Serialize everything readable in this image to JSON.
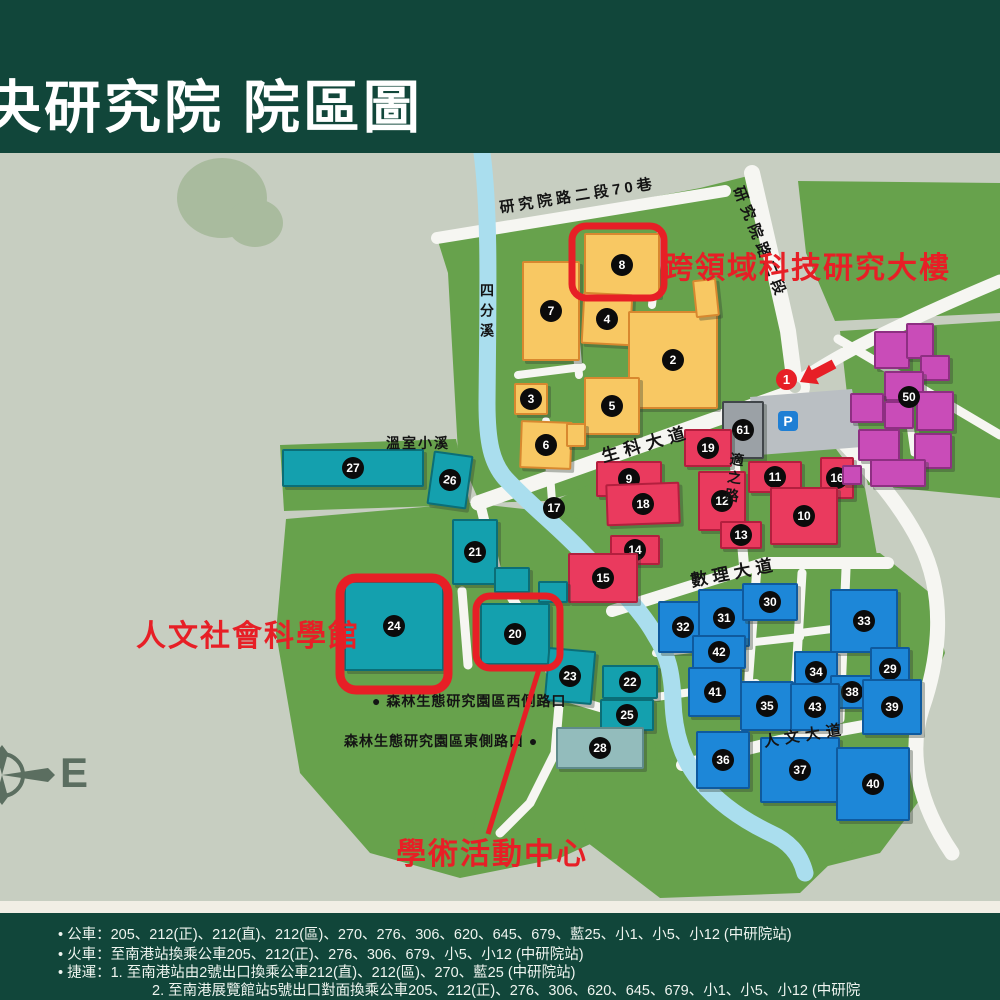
{
  "header": {
    "title": "中央研究院 院區圖"
  },
  "map": {
    "annotations": {
      "cross_domain": "跨領域科技研究大樓",
      "humanities": "人文社會科學館",
      "activity_center": "學術活動中心"
    },
    "markers": {
      "parking": "P",
      "gate": "1",
      "compass_east": "E"
    },
    "road_labels": [
      {
        "t": "研究院路二段70巷",
        "x": 498,
        "y": 44,
        "size": 15,
        "rot": -9,
        "spacing": 4
      },
      {
        "t": "研究院路二段",
        "x": 748,
        "y": 30,
        "size": 15,
        "rot": 68,
        "spacing": 5
      },
      {
        "t": "四分溪",
        "x": 477,
        "y": 130,
        "size": 14,
        "vertical": true,
        "spacing": 6
      },
      {
        "t": "溫室小溪",
        "x": 386,
        "y": 280,
        "size": 14,
        "spacing": 2
      },
      {
        "t": "生科大道",
        "x": 598,
        "y": 290,
        "size": 17,
        "rot": -16,
        "spacing": 6
      },
      {
        "t": "適之路",
        "x": 728,
        "y": 298,
        "size": 14,
        "vertical": true,
        "rot": 8,
        "spacing": 4
      },
      {
        "t": "數理大道",
        "x": 688,
        "y": 414,
        "size": 17,
        "rot": -11,
        "spacing": 5
      },
      {
        "t": "人文大道",
        "x": 762,
        "y": 578,
        "size": 15,
        "rot": -9,
        "spacing": 6
      },
      {
        "t": "● 森林生態研究園區西側路口",
        "x": 372,
        "y": 538,
        "size": 14,
        "spacing": 1
      },
      {
        "t": "森林生態研究園區東側路口 ●",
        "x": 344,
        "y": 578,
        "size": 14,
        "spacing": 1
      }
    ],
    "badges": [
      {
        "n": "17",
        "x": 554,
        "y": 355
      },
      {
        "n": "50",
        "x": 909,
        "y": 244
      }
    ],
    "buildings": [
      {
        "n": "7",
        "c": "yellow",
        "x": 522,
        "y": 108,
        "w": 54,
        "h": 96
      },
      {
        "n": "8",
        "c": "yellow",
        "x": 584,
        "y": 80,
        "w": 72,
        "h": 60
      },
      {
        "n": "4",
        "c": "yellow",
        "x": 582,
        "y": 140,
        "w": 46,
        "h": 48,
        "r": 3
      },
      {
        "n": "2",
        "c": "yellow",
        "x": 628,
        "y": 158,
        "w": 86,
        "h": 94
      },
      {
        "n": "3",
        "c": "yellow",
        "x": 514,
        "y": 230,
        "w": 30,
        "h": 28
      },
      {
        "n": "5",
        "c": "yellow",
        "x": 584,
        "y": 224,
        "w": 52,
        "h": 54
      },
      {
        "n": "6",
        "c": "yellow",
        "x": 520,
        "y": 268,
        "w": 48,
        "h": 44,
        "r": 2
      },
      {
        "n": "",
        "c": "yellow",
        "x": 566,
        "y": 270,
        "w": 16,
        "h": 20
      },
      {
        "n": "",
        "c": "yellow",
        "x": 694,
        "y": 126,
        "w": 20,
        "h": 34,
        "r": -6
      },
      {
        "n": "61",
        "c": "gray",
        "x": 722,
        "y": 248,
        "w": 38,
        "h": 54
      },
      {
        "n": "19",
        "c": "red",
        "x": 684,
        "y": 276,
        "w": 44,
        "h": 34
      },
      {
        "n": "9",
        "c": "red",
        "x": 596,
        "y": 308,
        "w": 62,
        "h": 32
      },
      {
        "n": "18",
        "c": "red",
        "x": 606,
        "y": 330,
        "w": 70,
        "h": 38,
        "r": -2
      },
      {
        "n": "12",
        "c": "red",
        "x": 698,
        "y": 318,
        "w": 44,
        "h": 56
      },
      {
        "n": "11",
        "c": "red",
        "x": 748,
        "y": 308,
        "w": 50,
        "h": 28
      },
      {
        "n": "16",
        "c": "red",
        "x": 820,
        "y": 304,
        "w": 30,
        "h": 38
      },
      {
        "n": "10",
        "c": "red",
        "x": 770,
        "y": 334,
        "w": 64,
        "h": 54
      },
      {
        "n": "13",
        "c": "red",
        "x": 720,
        "y": 368,
        "w": 38,
        "h": 24
      },
      {
        "n": "14",
        "c": "red",
        "x": 610,
        "y": 382,
        "w": 46,
        "h": 26
      },
      {
        "n": "15",
        "c": "red",
        "x": 568,
        "y": 400,
        "w": 66,
        "h": 46
      },
      {
        "n": "27",
        "c": "teal",
        "x": 282,
        "y": 296,
        "w": 138,
        "h": 34
      },
      {
        "n": "26",
        "c": "teal",
        "x": 430,
        "y": 300,
        "w": 36,
        "h": 50,
        "r": 8
      },
      {
        "n": "21",
        "c": "teal",
        "x": 452,
        "y": 366,
        "w": 42,
        "h": 62
      },
      {
        "n": "",
        "c": "teal",
        "x": 494,
        "y": 414,
        "w": 32,
        "h": 22
      },
      {
        "n": "",
        "c": "teal",
        "x": 538,
        "y": 428,
        "w": 26,
        "h": 18
      },
      {
        "n": "24",
        "c": "teal",
        "x": 344,
        "y": 428,
        "w": 96,
        "h": 86
      },
      {
        "n": "20",
        "c": "teal",
        "x": 480,
        "y": 450,
        "w": 66,
        "h": 58
      },
      {
        "n": "23",
        "c": "teal",
        "x": 546,
        "y": 496,
        "w": 44,
        "h": 50,
        "r": 5
      },
      {
        "n": "22",
        "c": "teal",
        "x": 602,
        "y": 512,
        "w": 52,
        "h": 30
      },
      {
        "n": "25",
        "c": "teal",
        "x": 600,
        "y": 546,
        "w": 50,
        "h": 28
      },
      {
        "n": "28",
        "c": "grayteal",
        "x": 556,
        "y": 574,
        "w": 84,
        "h": 38
      },
      {
        "n": "32",
        "c": "blue",
        "x": 658,
        "y": 448,
        "w": 46,
        "h": 48
      },
      {
        "n": "31",
        "c": "blue",
        "x": 698,
        "y": 436,
        "w": 48,
        "h": 54
      },
      {
        "n": "30",
        "c": "blue",
        "x": 742,
        "y": 430,
        "w": 52,
        "h": 34
      },
      {
        "n": "42",
        "c": "blue",
        "x": 692,
        "y": 482,
        "w": 50,
        "h": 30
      },
      {
        "n": "41",
        "c": "blue",
        "x": 688,
        "y": 514,
        "w": 50,
        "h": 46
      },
      {
        "n": "33",
        "c": "blue",
        "x": 830,
        "y": 436,
        "w": 64,
        "h": 60
      },
      {
        "n": "34",
        "c": "blue",
        "x": 794,
        "y": 498,
        "w": 40,
        "h": 38
      },
      {
        "n": "38",
        "c": "blue",
        "x": 830,
        "y": 522,
        "w": 40,
        "h": 30
      },
      {
        "n": "29",
        "c": "blue",
        "x": 870,
        "y": 494,
        "w": 36,
        "h": 40
      },
      {
        "n": "35",
        "c": "blue",
        "x": 740,
        "y": 528,
        "w": 50,
        "h": 46
      },
      {
        "n": "43",
        "c": "blue",
        "x": 790,
        "y": 530,
        "w": 46,
        "h": 44
      },
      {
        "n": "39",
        "c": "blue",
        "x": 862,
        "y": 526,
        "w": 56,
        "h": 52
      },
      {
        "n": "36",
        "c": "blue",
        "x": 696,
        "y": 578,
        "w": 50,
        "h": 54
      },
      {
        "n": "37",
        "c": "blue",
        "x": 760,
        "y": 584,
        "w": 76,
        "h": 62
      },
      {
        "n": "40",
        "c": "blue",
        "x": 836,
        "y": 594,
        "w": 70,
        "h": 70
      },
      {
        "n": "",
        "c": "magenta",
        "x": 874,
        "y": 178,
        "w": 32,
        "h": 34
      },
      {
        "n": "",
        "c": "magenta",
        "x": 906,
        "y": 170,
        "w": 24,
        "h": 32
      },
      {
        "n": "",
        "c": "magenta",
        "x": 920,
        "y": 202,
        "w": 26,
        "h": 22
      },
      {
        "n": "",
        "c": "magenta",
        "x": 884,
        "y": 218,
        "w": 36,
        "h": 26
      },
      {
        "n": "",
        "c": "magenta",
        "x": 850,
        "y": 240,
        "w": 30,
        "h": 26
      },
      {
        "n": "",
        "c": "magenta",
        "x": 884,
        "y": 248,
        "w": 26,
        "h": 24
      },
      {
        "n": "",
        "c": "magenta",
        "x": 916,
        "y": 238,
        "w": 34,
        "h": 36
      },
      {
        "n": "",
        "c": "magenta",
        "x": 858,
        "y": 276,
        "w": 38,
        "h": 28
      },
      {
        "n": "",
        "c": "magenta",
        "x": 914,
        "y": 280,
        "w": 34,
        "h": 32
      },
      {
        "n": "",
        "c": "magenta",
        "x": 870,
        "y": 306,
        "w": 52,
        "h": 24
      },
      {
        "n": "",
        "c": "magenta",
        "x": 842,
        "y": 312,
        "w": 16,
        "h": 16
      }
    ],
    "colors": {
      "header_green": "#11463a",
      "campus_green": "#67a24c",
      "background_sage": "#c7cec1",
      "road_white": "#f6f6f2",
      "river_blue": "#aadeee",
      "annotation_red": "#e71f26",
      "yellow": "#f8c863",
      "red": "#ea3a5e",
      "teal": "#14a0ae",
      "blue": "#1d87d8",
      "magenta": "#c94cb8",
      "gray": "#9ba1a6"
    }
  },
  "footer": {
    "lines": [
      "•  公車：205、212(正)、212(直)、212(區)、270、276、306、620、645、679、藍25、小1、小5、小12 (中研院站)",
      "•  火車：至南港站換乘公車205、212(正)、276、306、679、小5、小12 (中研院站)",
      "•  捷運：1. 至南港站由2號出口換乘公車212(直)、212(區)、270、藍25 (中研院站)",
      "2. 至南港展覽館站5號出口對面換乘公車205、212(正)、276、306、620、645、679、小1、小5、小12 (中研院"
    ]
  }
}
